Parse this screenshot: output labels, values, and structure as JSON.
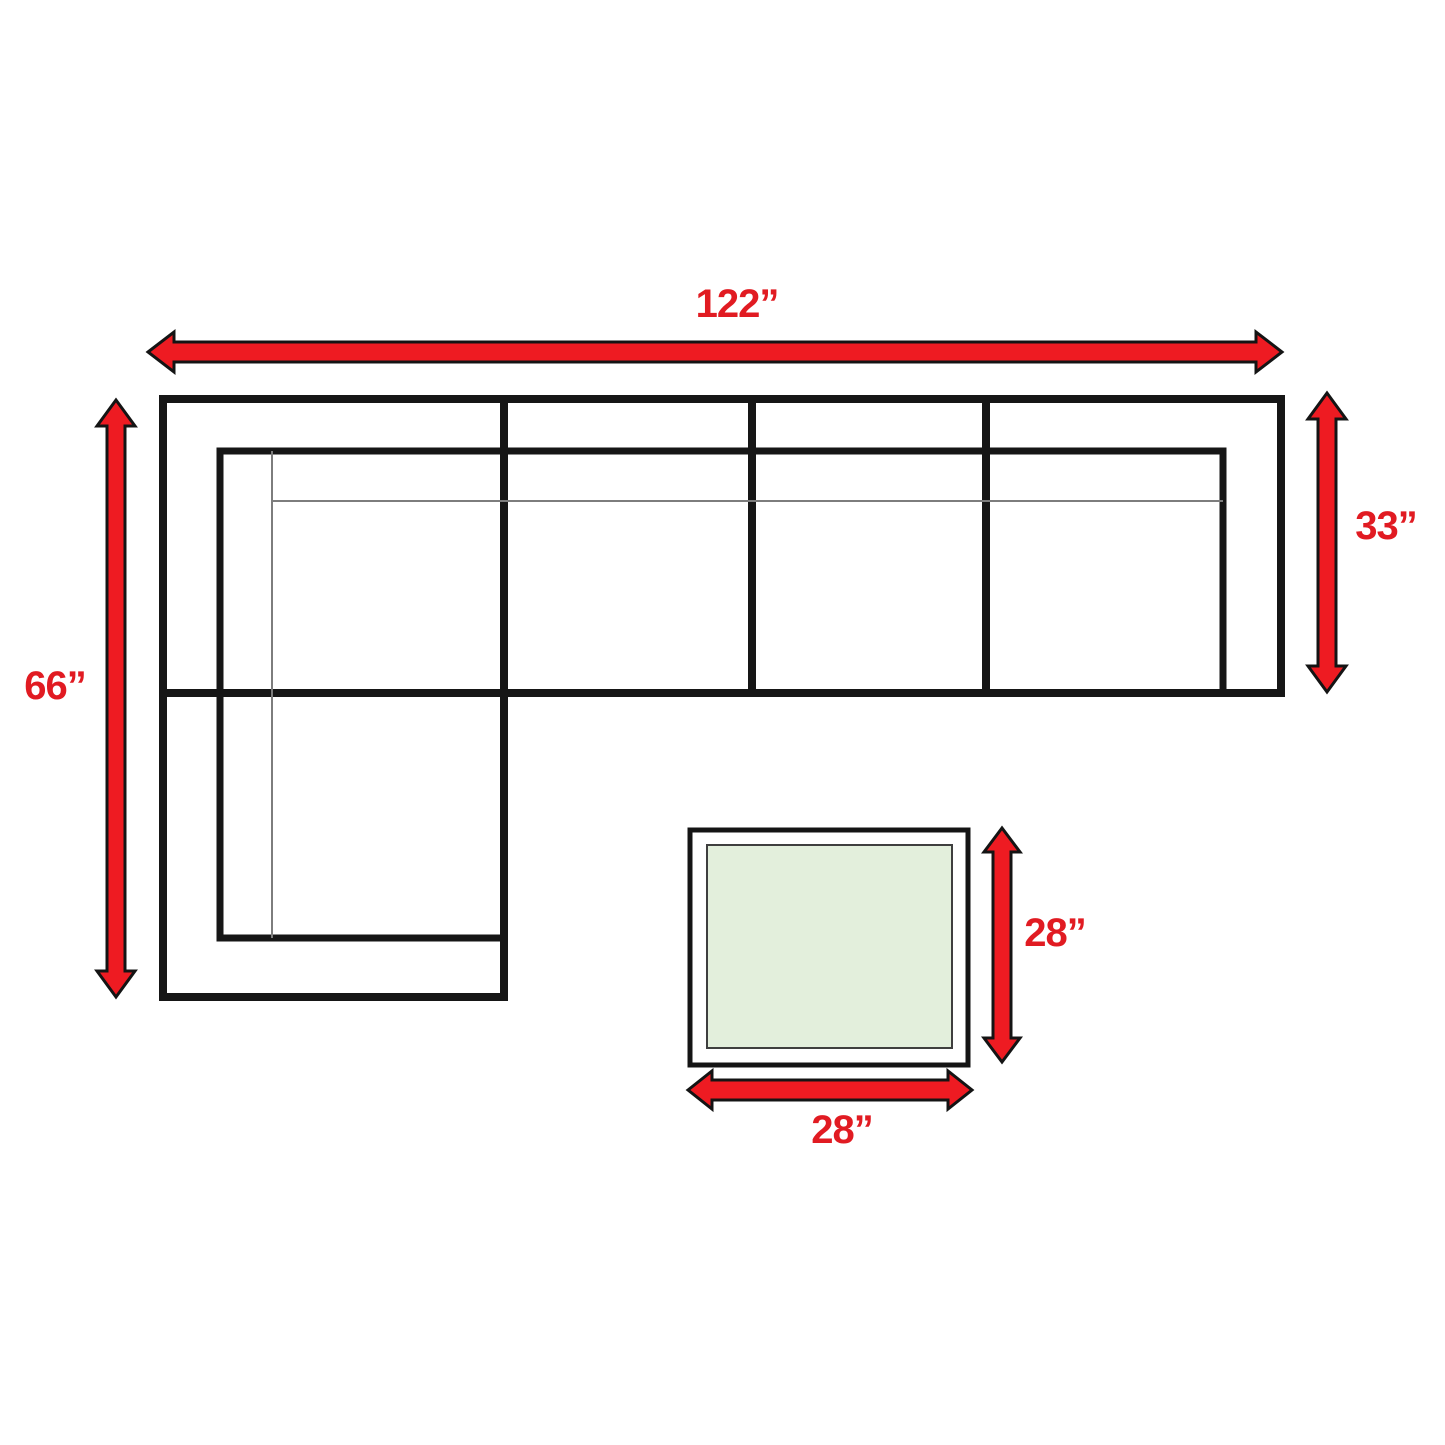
{
  "diagram": {
    "name": "sectional-sofa-and-table-dimension-diagram"
  },
  "dimensions": [
    {
      "id": "sofa-overall-width",
      "label": "122”"
    },
    {
      "id": "sofa-chaise-depth",
      "label": "66”"
    },
    {
      "id": "sofa-body-depth",
      "label": "33”"
    },
    {
      "id": "table-depth",
      "label": "28”"
    },
    {
      "id": "table-width",
      "label": "28”"
    }
  ],
  "colors": {
    "arrow_red": "#ee1b22",
    "label_red": "#e11b22",
    "outline_black": "#161616",
    "table_fill_green": "#e3efdc",
    "background_white": "#ffffff"
  }
}
